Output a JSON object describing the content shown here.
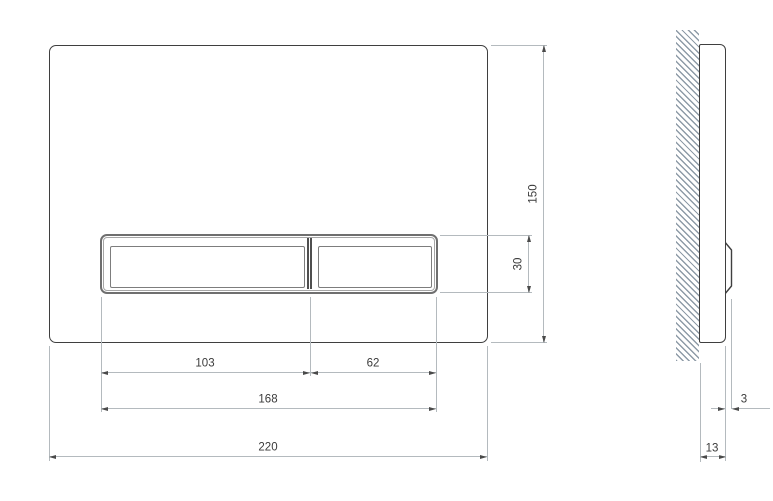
{
  "drawing": {
    "type": "technical-dimension-drawing",
    "subject": "flush-plate with two buttons, front view and side section view"
  },
  "dimensions": {
    "plate_width": "220",
    "plate_height": "150",
    "buttons_total_width": "168",
    "button_large_width": "103",
    "button_small_width": "62",
    "button_height": "30",
    "plate_depth": "13",
    "button_protrusion": "3"
  },
  "colors": {
    "outline": "#3f3f3f",
    "frame_gray": "#6f6f6f",
    "dim_line": "#b4babe",
    "arrow": "#4a4a4a",
    "hatch": "#8e9ba7",
    "text": "#3a3a3a",
    "background": "#ffffff"
  }
}
